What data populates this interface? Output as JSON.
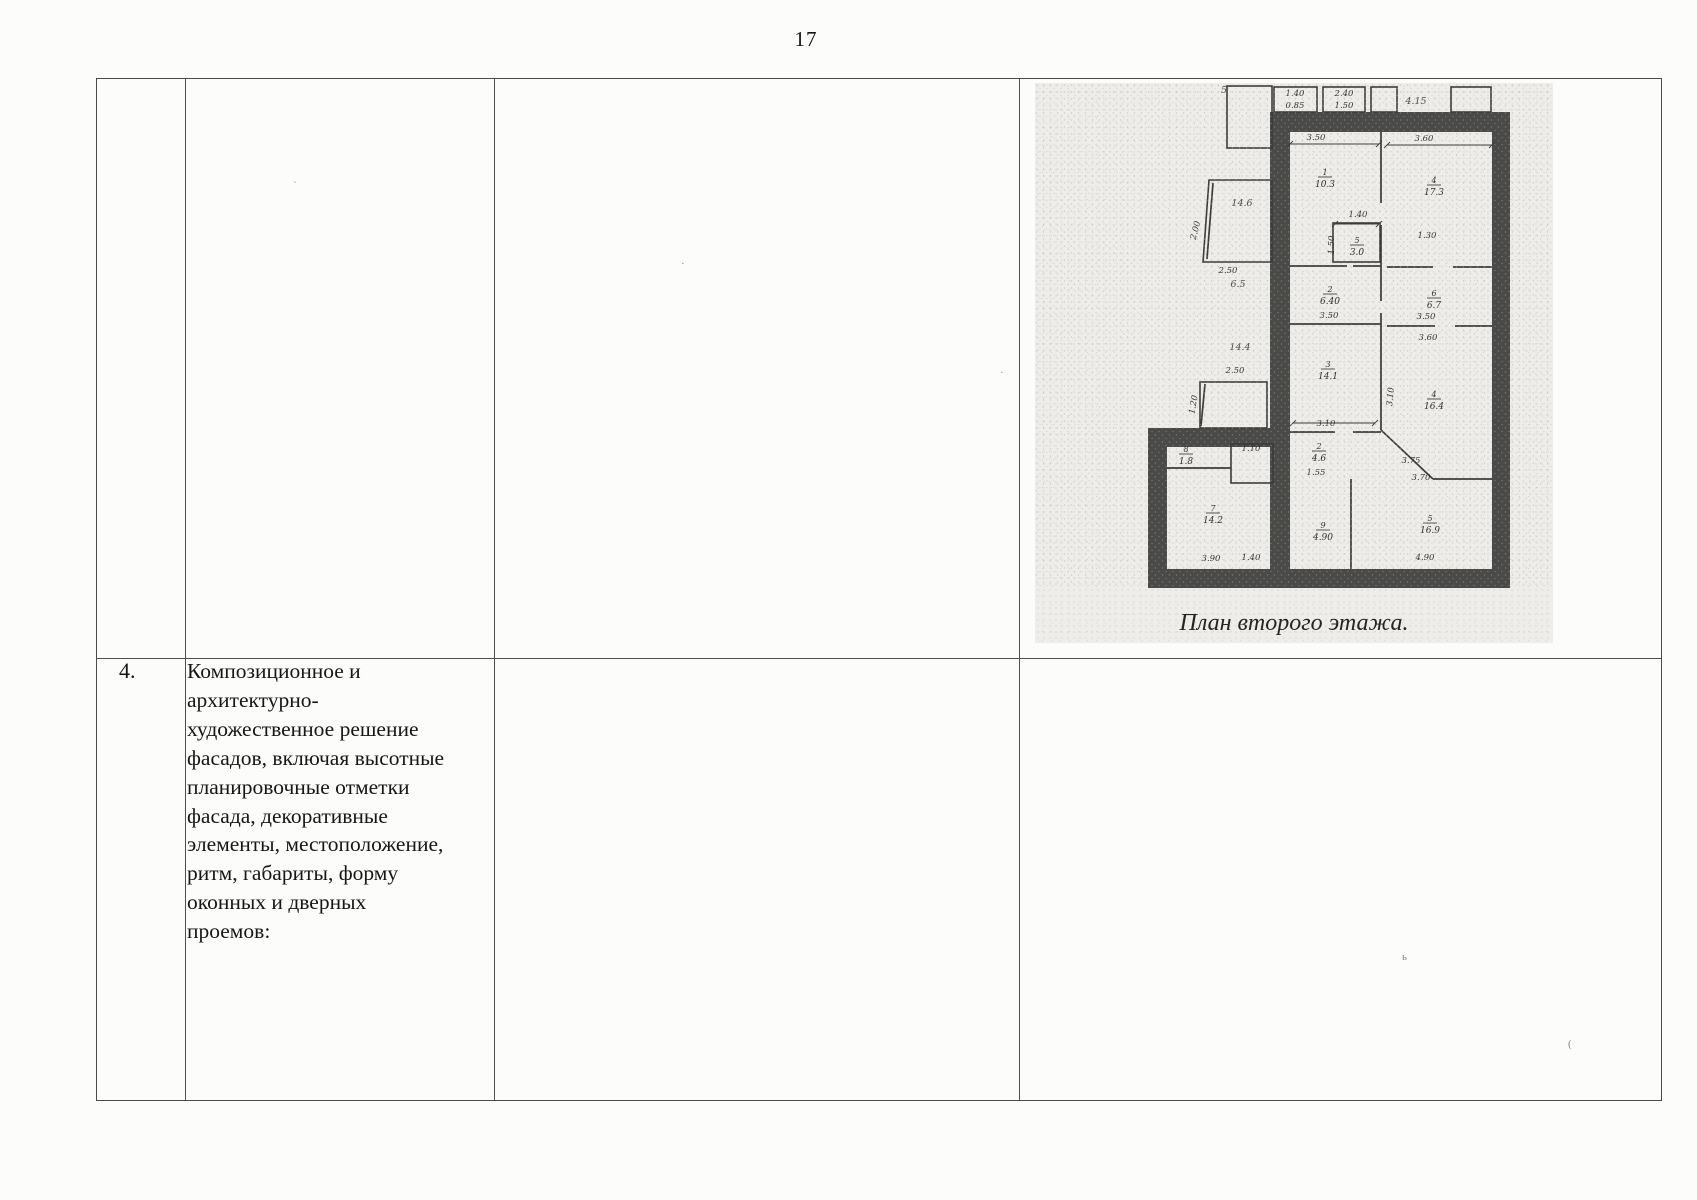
{
  "page": {
    "number": "17"
  },
  "table": {
    "row4": {
      "num": "4.",
      "description": "Композиционное и\nархитектурно-\nхудожественное решение\nфасадов, включая высотные\nпланировочные отметки\nфасада, декоративные\nэлементы, местоположение,\nритм, габариты, форму\nоконных и дверных\nпроемов:"
    }
  },
  "floorplan": {
    "caption": "План второго этажа.",
    "rooms": [
      {
        "n": "1",
        "a": "10.3",
        "x": 290,
        "y": 95
      },
      {
        "n": "4",
        "a": "17.3",
        "x": 399,
        "y": 103
      },
      {
        "n": "5",
        "a": "3.0",
        "x": 322,
        "y": 163
      },
      {
        "n": "2",
        "a": "6.40",
        "x": 295,
        "y": 212
      },
      {
        "n": "6",
        "a": "6.7",
        "x": 399,
        "y": 216
      },
      {
        "n": "3",
        "a": "14.1",
        "x": 293,
        "y": 287
      },
      {
        "n": "4",
        "a": "16.4",
        "x": 399,
        "y": 317
      },
      {
        "n": "2",
        "a": "4.6",
        "x": 284,
        "y": 369
      },
      {
        "n": "9",
        "a": "4.90",
        "x": 288,
        "y": 448
      },
      {
        "n": "5",
        "a": "16.9",
        "x": 395,
        "y": 441
      },
      {
        "n": "7",
        "a": "14.2",
        "x": 178,
        "y": 431
      },
      {
        "n": "8",
        "a": "1.8",
        "x": 151,
        "y": 372
      }
    ],
    "dims": [
      {
        "t": "5",
        "x": 189,
        "y": 10,
        "hand": 1
      },
      {
        "t": "1.40",
        "x": 260,
        "y": 13
      },
      {
        "t": "0.85",
        "x": 260,
        "y": 25
      },
      {
        "t": "2.40",
        "x": 309,
        "y": 13
      },
      {
        "t": "1.50",
        "x": 309,
        "y": 25
      },
      {
        "t": "4.15",
        "x": 381,
        "y": 21,
        "hand": 1
      },
      {
        "t": "3.50",
        "x": 281,
        "y": 57
      },
      {
        "t": "3.60",
        "x": 389,
        "y": 58
      },
      {
        "t": "2.00",
        "x": 163,
        "y": 148,
        "rot": -75
      },
      {
        "t": "14.6",
        "x": 207,
        "y": 123,
        "hand": 1
      },
      {
        "t": "1.40",
        "x": 323,
        "y": 134
      },
      {
        "t": "1.50",
        "x": 299,
        "y": 162,
        "rot": -90
      },
      {
        "t": "1.30",
        "x": 392,
        "y": 155
      },
      {
        "t": "2.50",
        "x": 193,
        "y": 190
      },
      {
        "t": "6.5",
        "x": 203,
        "y": 204,
        "hand": 1
      },
      {
        "t": "14.4",
        "x": 205,
        "y": 267,
        "hand": 1
      },
      {
        "t": "2.50",
        "x": 200,
        "y": 290
      },
      {
        "t": "1.20",
        "x": 161,
        "y": 322,
        "rot": -80
      },
      {
        "t": "3.50",
        "x": 294,
        "y": 235
      },
      {
        "t": "3.50",
        "x": 391,
        "y": 236
      },
      {
        "t": "3.60",
        "x": 393,
        "y": 257
      },
      {
        "t": "3.10",
        "x": 291,
        "y": 343
      },
      {
        "t": "3.10",
        "x": 358,
        "y": 314,
        "rot": -85
      },
      {
        "t": "1.55",
        "x": 281,
        "y": 392
      },
      {
        "t": "3.75",
        "x": 376,
        "y": 380
      },
      {
        "t": "3.70",
        "x": 386,
        "y": 397
      },
      {
        "t": "1.10",
        "x": 216,
        "y": 368
      },
      {
        "t": "3.90",
        "x": 176,
        "y": 478
      },
      {
        "t": "1.40",
        "x": 216,
        "y": 477
      },
      {
        "t": "4.90",
        "x": 390,
        "y": 477
      }
    ]
  },
  "colors": {
    "table_line": "#4f4f4f",
    "wall": "#4a4a48",
    "plan_line": "#3c3c3c",
    "scan_bg": "#efede9",
    "text": "#1b1b1b"
  }
}
